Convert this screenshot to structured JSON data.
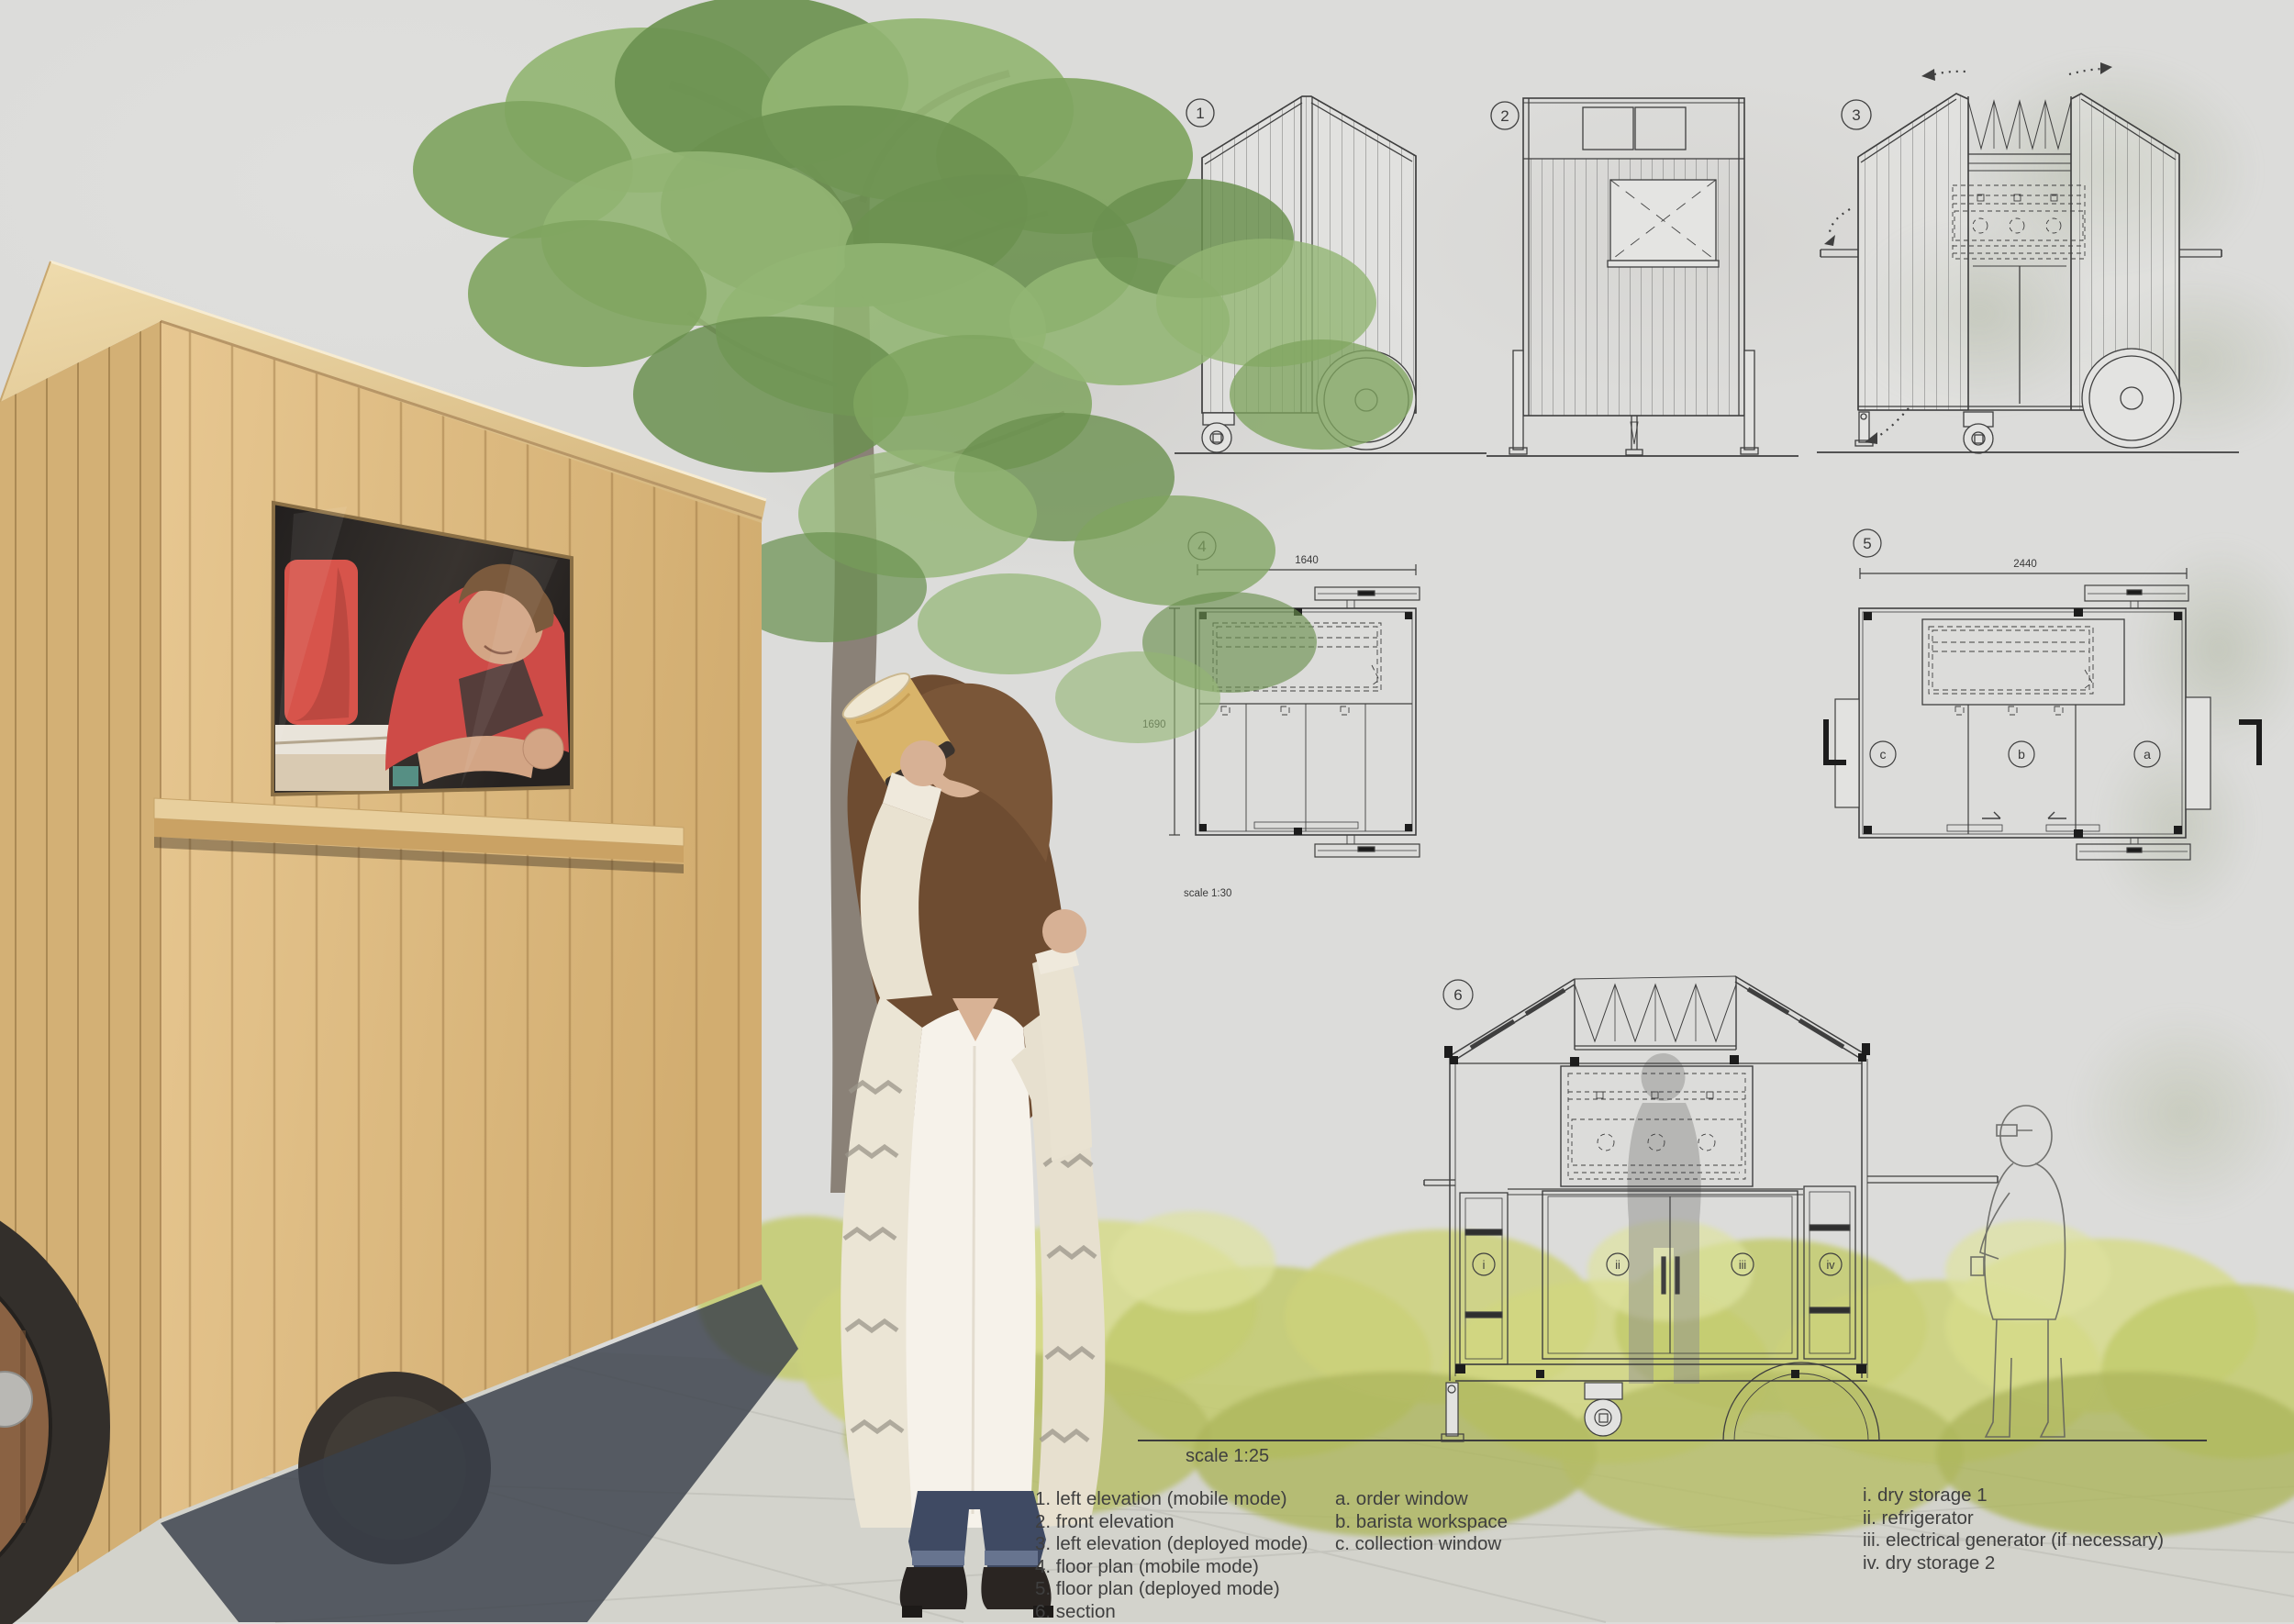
{
  "drawings": {
    "d1": {
      "number": "1"
    },
    "d2": {
      "number": "2"
    },
    "d3": {
      "number": "3"
    },
    "d4": {
      "number": "4",
      "dim_width": "1640",
      "dim_height": "1690",
      "scale": "scale 1:30"
    },
    "d5": {
      "number": "5",
      "dim_width": "2440",
      "zones": {
        "a": "a",
        "b": "b",
        "c": "c"
      }
    },
    "d6": {
      "number": "6",
      "scale": "scale 1:25",
      "units": {
        "i": "i",
        "ii": "ii",
        "iii": "iii",
        "iv": "iv"
      }
    }
  },
  "legend": {
    "drawings": [
      "1. left elevation (mobile mode)",
      "2. front elevation",
      "3. left elevation (deployed mode)",
      "4. floor plan (mobile mode)",
      "5. floor plan (deployed mode)",
      "6. section"
    ],
    "windows": [
      "a. order window",
      "b. barista workspace",
      "c. collection window"
    ],
    "equipment": [
      "i. dry storage 1",
      "ii. refrigerator",
      "iii. electrical generator (if necessary)",
      "iv. dry storage 2"
    ]
  },
  "colors": {
    "wood": "#ddbf8c",
    "accent_red": "#d6554a",
    "foliage_green": "#7fa862",
    "bush_yellow_green": "#ccd17b",
    "drawing_line": "#3f3f3f",
    "wall_gray": "#dcdcda",
    "pavement_gray": "#d3d3cc"
  }
}
